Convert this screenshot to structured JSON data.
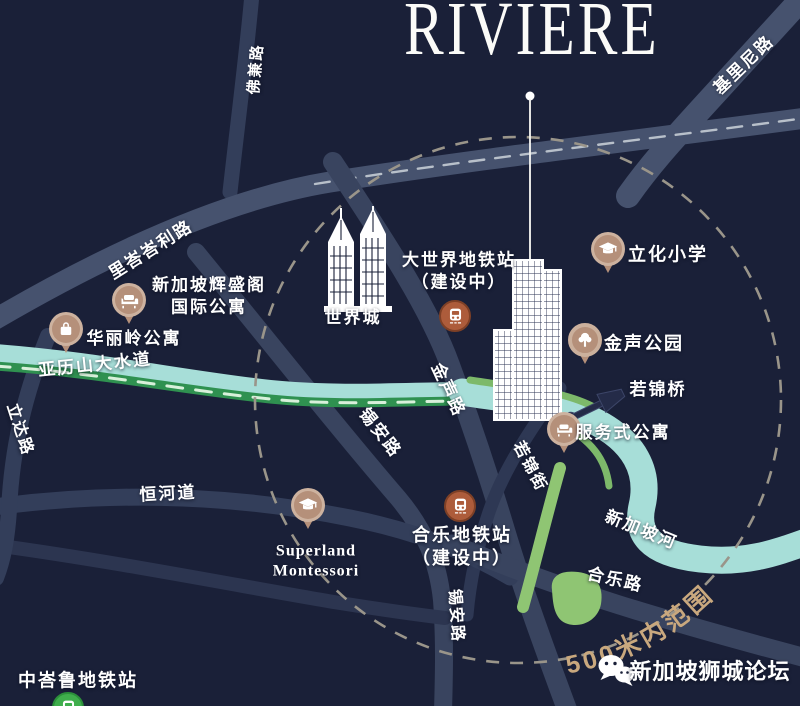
{
  "title": "RIVIÈRE",
  "map": {
    "radius_label": "500米内范围",
    "roads": {
      "hoot_kiam": "佛兼路",
      "killiney": "基里尼路",
      "river_valley": "里峇峇利路",
      "kim_seng": "金声路",
      "zion_mid": "锡安路",
      "zion_south": "锡安路",
      "jiak_kim_street": "若锦街",
      "ganges_avenue": "恒河道",
      "havelock": "合乐路",
      "delta": "立达路"
    },
    "waterways": {
      "alexandra_canal": "亚历山大水道",
      "singapore_river": "新加坡河"
    },
    "stations": {
      "great_world": {
        "name": "大世界地铁站",
        "status": "（建设中）",
        "icon": "train-icon",
        "color": "#ad5c3b"
      },
      "havelock": {
        "name": "合乐地铁站",
        "status": "（建设中）",
        "icon": "train-icon",
        "color": "#ad5c3b"
      },
      "tiong_bahru": {
        "name": "中峇鲁地铁站",
        "icon": "train-icon",
        "color": "#3fae4c"
      }
    },
    "pois": {
      "fraser_suites": {
        "line1": "新加坡辉盛阁",
        "line2": "国际公寓",
        "icon": "sofa-icon"
      },
      "valley_point": {
        "label": "华丽岭公寓",
        "icon": "shopping-bag-icon"
      },
      "river_valley_primary": {
        "label": "立化小学",
        "icon": "graduation-cap-icon"
      },
      "kim_seng_park": {
        "label": "金声公园",
        "icon": "tree-icon"
      },
      "jiak_kim_bridge": {
        "label": "若锦桥",
        "icon": "bridge-icon"
      },
      "serviced_apartments": {
        "label": "服务式公寓",
        "icon": "sofa-icon"
      },
      "superland": {
        "line1": "Superland",
        "line2": "Montessori",
        "icon": "graduation-cap-icon"
      },
      "great_world_city": {
        "label": "世界城",
        "icon": "twin-towers-icon"
      },
      "riviere_building": {
        "icon": "skyscraper-icon"
      }
    }
  },
  "watermark": {
    "brand": "新加坡狮城论坛",
    "icon": "wechat-icon"
  },
  "colors": {
    "background": "#1a2038",
    "road": "#39445f",
    "road_major": "#46526e",
    "water_teal": "#a7ded8",
    "canal_green": "#2f9150",
    "park_green": "#8fc573",
    "pin_tan": "#b5907a",
    "mrt_under_construction": "#ad5c3b",
    "mrt_open": "#3fae4c",
    "radius_dash": "#9a958a",
    "radius_text": "#c9a87e",
    "label_text": "#ffffff"
  }
}
